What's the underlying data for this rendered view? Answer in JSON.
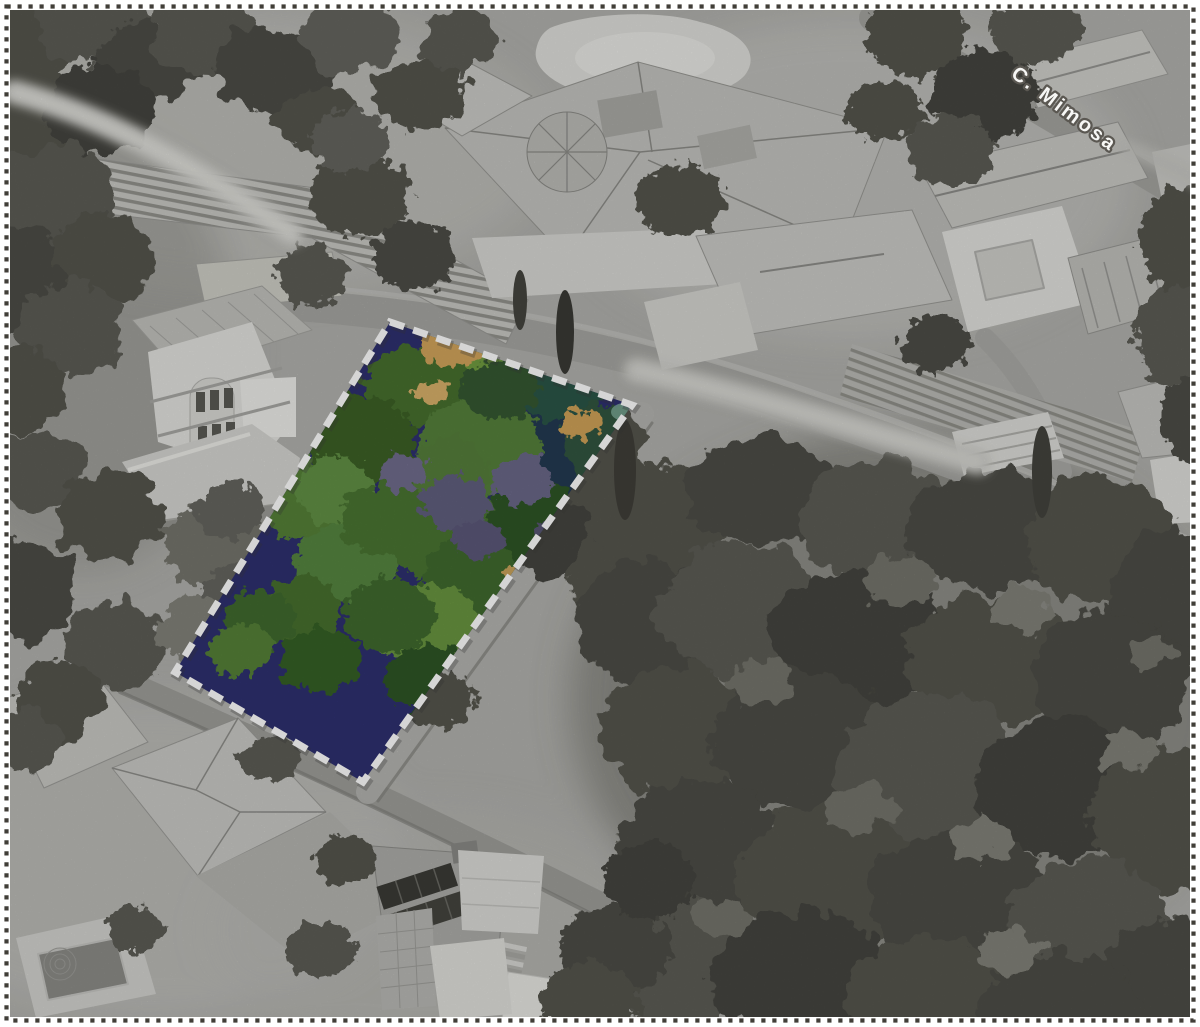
{
  "figure": {
    "street_label": "C. Mimosa",
    "highlight": {
      "outline_color": "#ffffff",
      "outline_style": "dashed"
    },
    "palette": {
      "page_background": "#ffffff",
      "stitch_border": "#413e38",
      "photo_base_gray": "#b1b1ad",
      "tree_canopy_gray": "#4d4d46",
      "roof_light_gray": "#d8d8d4",
      "road_gray": "#a6a6a2",
      "parcel_shadow_navy": "#2e3070",
      "parcel_green": "#54803a",
      "parcel_bright_green": "#abc23f",
      "parcel_tan": "#d2a55c",
      "street_label_fill": "#f7f7f5",
      "street_label_outline": "#5b5852"
    }
  }
}
